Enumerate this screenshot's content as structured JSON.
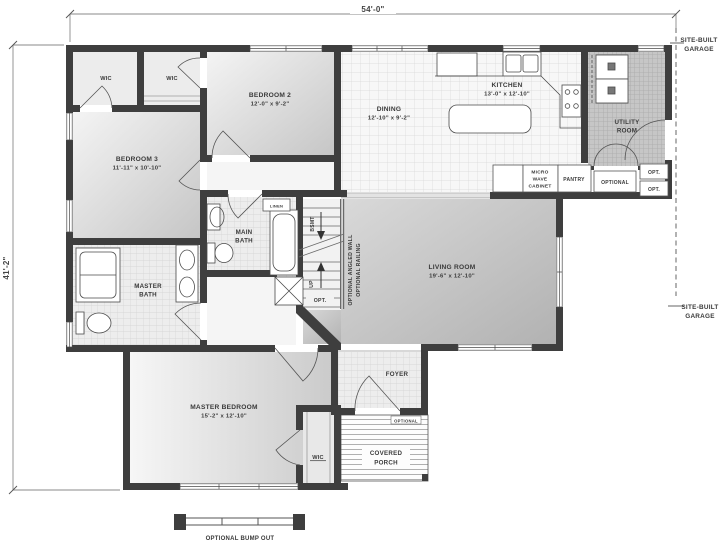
{
  "plan": {
    "dimensions": {
      "width": "54'-0\"",
      "height": "41'-2\""
    },
    "garage_note": {
      "line1": "SITE-BUILT",
      "line2": "GARAGE"
    },
    "rooms": {
      "bedroom2": {
        "name": "BEDROOM 2",
        "size": "12'-0\" x 9'-2\""
      },
      "bedroom3": {
        "name": "BEDROOM 3",
        "size": "11'-11\" x 10'-10\""
      },
      "dining": {
        "name": "DINING",
        "size": "12'-10\" x 9'-2\""
      },
      "kitchen": {
        "name": "KITCHEN",
        "size": "13'-0\" x 12'-10\""
      },
      "living": {
        "name": "LIVING ROOM",
        "size": "19'-6\" x 12'-10\""
      },
      "master_bedroom": {
        "name": "MASTER BEDROOM",
        "size": "15'-2\" x 12'-10\""
      },
      "master_bath": {
        "line1": "MASTER",
        "line2": "BATH"
      },
      "main_bath": {
        "line1": "MAIN",
        "line2": "BATH"
      },
      "utility": {
        "line1": "UTILITY",
        "line2": "ROOM"
      },
      "foyer": {
        "name": "FOYER"
      },
      "porch": {
        "line1": "COVERED",
        "line2": "PORCH",
        "tag": "OPTIONAL"
      },
      "wic": "WIC",
      "linen": "LINEN"
    },
    "features": {
      "micro_cabinet": {
        "line1": "MICRO",
        "line2": "WAVE",
        "line3": "CABINET"
      },
      "pantry": "PANTRY",
      "optional": "OPTIONAL",
      "opt": "OPT.",
      "stairs": {
        "bsmt": "BSMT",
        "up": "UP",
        "opt": "OPT."
      },
      "angled_wall_note": "OPTIONAL ANGLED WALL",
      "railing_note": "OPTIONAL RAILING",
      "bump_out": "OPTIONAL BUMP OUT"
    },
    "colors": {
      "wall": "#3e3e3e",
      "text": "#3a3a3a",
      "dim_line": "#8a8a8a"
    }
  }
}
